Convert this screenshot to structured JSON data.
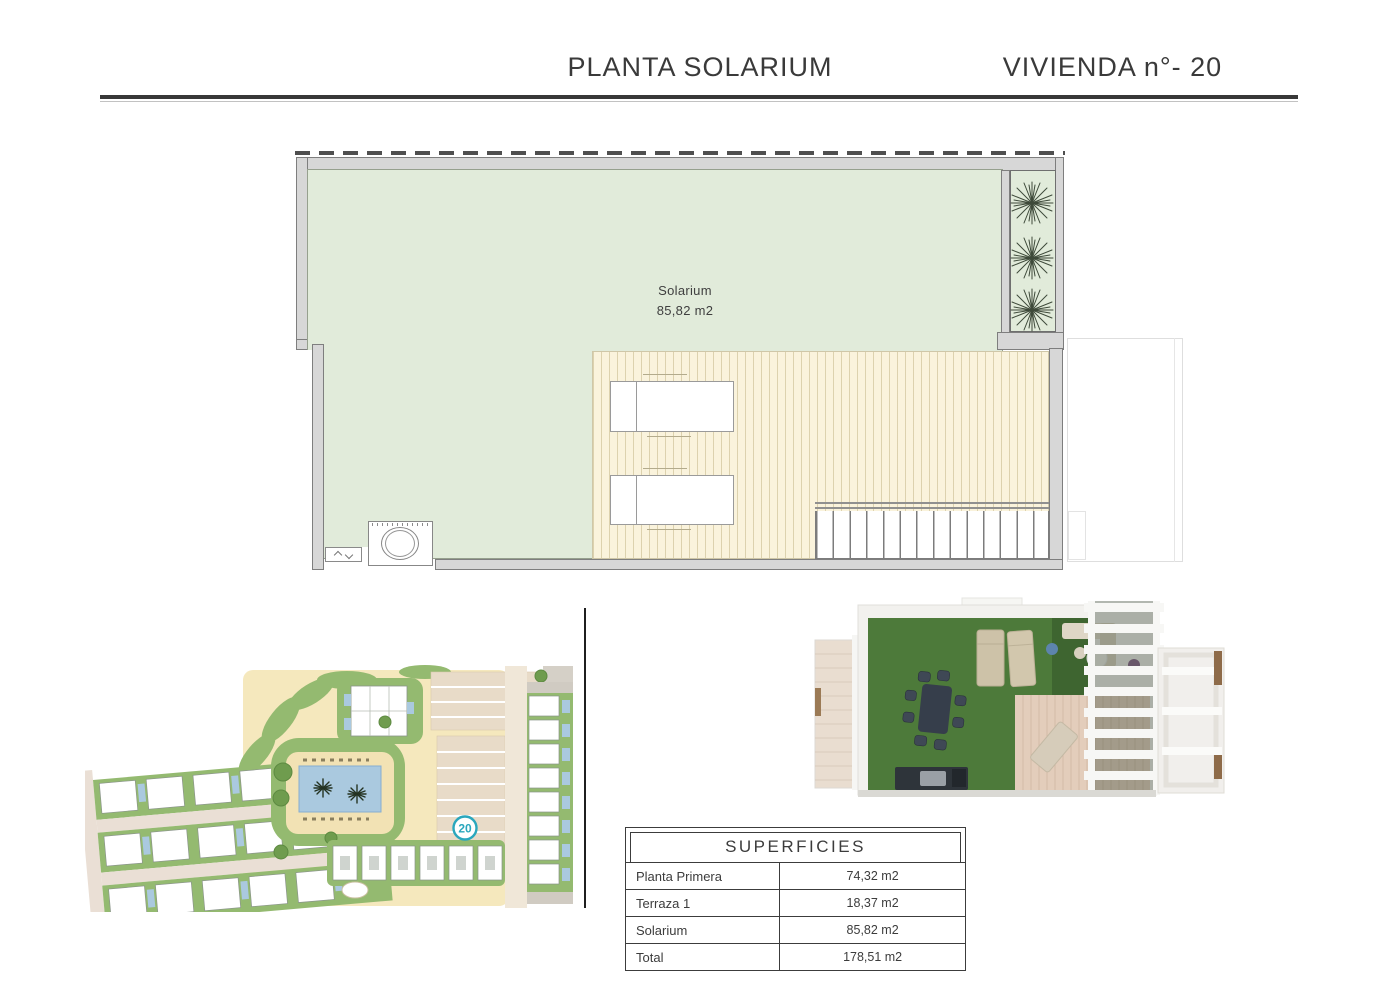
{
  "header": {
    "title_left": "PLANTA SOLARIUM",
    "title_right": "VIVIENDA n°- 20"
  },
  "floor_plan": {
    "room_label": "Solarium",
    "room_area": "85,82 m2"
  },
  "site_plan": {
    "unit_badge": "20"
  },
  "surfaces_table": {
    "title": "SUPERFICIES",
    "rows": [
      {
        "label": "Planta Primera",
        "value": "74,32 m2"
      },
      {
        "label": "Terraza 1",
        "value": "18,37 m2"
      },
      {
        "label": "Solarium",
        "value": "85,82 m2"
      },
      {
        "label": "Total",
        "value": "178,51 m2"
      }
    ]
  },
  "colors": {
    "accent_teal": "#2aa7bd",
    "plan_green": "#e1ebda",
    "deck_cream": "#faf3dc",
    "wall_gray": "#d7d7d7",
    "site_grass": "#94ba70",
    "site_sand": "#f5e8bd",
    "pool_blue": "#aac9df",
    "line_dark": "#3c3c3c"
  }
}
